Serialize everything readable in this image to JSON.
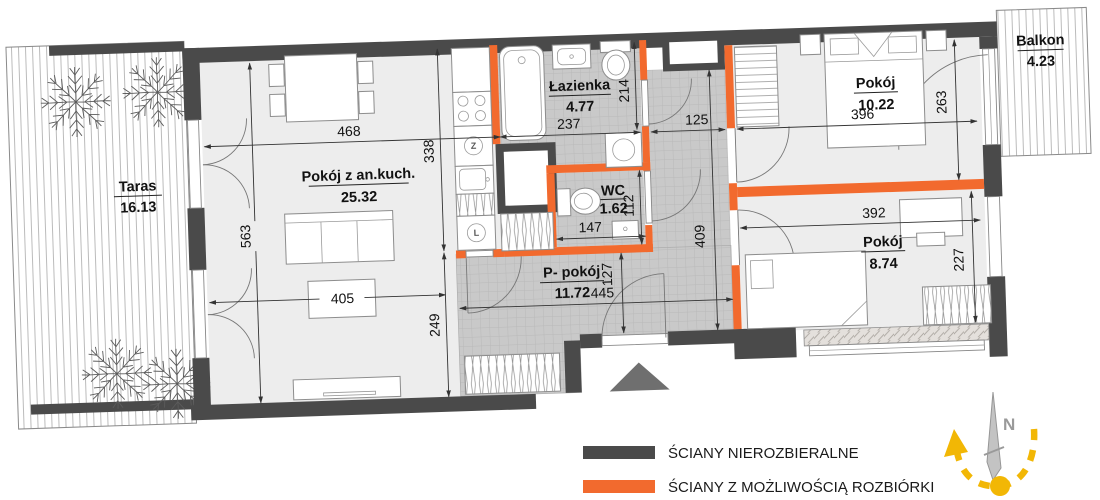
{
  "plan": {
    "rooms": {
      "taras": {
        "label": "Taras",
        "area": "16.13"
      },
      "living": {
        "label": "Pokój z an.kuch.",
        "area": "25.32"
      },
      "bath": {
        "label": "Łazienka",
        "area": "4.77"
      },
      "wc": {
        "label": "WC",
        "area": "1.62"
      },
      "hall": {
        "label": "P- pokój",
        "area": "11.72"
      },
      "bedroom1": {
        "label": "Pokój",
        "area": "10.22"
      },
      "bedroom2": {
        "label": "Pokój",
        "area": "8.74"
      },
      "balcony": {
        "label": "Balkon",
        "area": "4.23"
      }
    },
    "dims": {
      "living_width": "468",
      "living_height": "563",
      "living_table": "405",
      "living_lower": "249",
      "kitchen_height": "338",
      "bath_width": "237",
      "bath_height": "214",
      "bath_door": "125",
      "wc_width": "147",
      "wc_height": "112",
      "hall_width": "445",
      "hall_height": "127",
      "corridor_height": "409",
      "bedroom1_width": "396",
      "bedroom1_depth": "263",
      "bedroom2_width": "392",
      "bedroom2_depth": "227"
    },
    "kitchen": {
      "dishwasher_symbol": "Z",
      "fridge_symbol": "L"
    }
  },
  "legend": {
    "items": [
      {
        "label": "ŚCIANY NIEROZBIERALNE",
        "color": "#4a4a4a"
      },
      {
        "label": "ŚCIANY Z MOŻLIWOŚCIĄ ROZBIÓRKI",
        "color": "#f26a2e"
      }
    ]
  },
  "compass": {
    "north_label": "N"
  },
  "colors": {
    "wall_dark": "#4a4a4a",
    "wall_orange": "#f26a2e",
    "room_fill": "#ededed",
    "tile_fill": "#c9c9c9"
  }
}
